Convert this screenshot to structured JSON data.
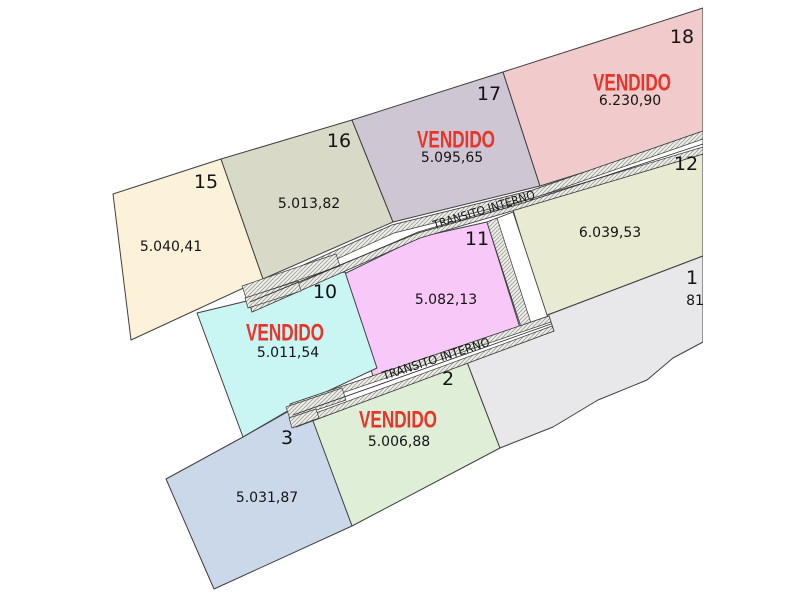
{
  "canvas": {
    "width": 800,
    "height": 600,
    "background": "#ffffff"
  },
  "plan": {
    "sold_label": "VENDIDO",
    "road_label": "TRANSITO INTERNO",
    "colors": {
      "sold_text": "#e8352b",
      "label_text": "#141414",
      "lot_outline": "#3f3f3f",
      "road_fill": "#ffffff",
      "road_outline": "#3f3f3f",
      "hatch_line": "#a0a099",
      "hatch_bg": "#f0f0ec",
      "centerline": "#2f2f2f"
    },
    "lots": [
      {
        "id": "15",
        "number": "15",
        "area": "5.040,41",
        "sold": false,
        "color": "#fcf2d9",
        "points": "113,194 221,159 263,279 131,340",
        "number_pos": [
          206,
          182
        ],
        "area_pos": [
          171,
          247
        ]
      },
      {
        "id": "16",
        "number": "16",
        "area": "5.013,82",
        "sold": false,
        "color": "#d9d9c7",
        "points": "221,159 352,120 393,222 263,279",
        "number_pos": [
          339,
          141
        ],
        "area_pos": [
          309,
          204
        ]
      },
      {
        "id": "17",
        "number": "17",
        "area": "5.095,65",
        "sold": true,
        "color": "#cfc6d3",
        "points": "352,120 503,72 540,186 393,222",
        "number_pos": [
          489,
          94
        ],
        "area_pos": [
          452,
          158
        ],
        "sold_pos": [
          456,
          140
        ]
      },
      {
        "id": "18",
        "number": "18",
        "area": "6.230,90",
        "sold": true,
        "color": "#f1cbcb",
        "points": "503,72 703,8 703,135 540,186",
        "number_pos": [
          682,
          37
        ],
        "area_pos": [
          630,
          101
        ],
        "sold_pos": [
          632,
          83
        ]
      },
      {
        "id": "12",
        "number": "12",
        "area": "6.039,53",
        "sold": false,
        "color": "#e9ead2",
        "points": "513,210 703,152 703,256 545,316",
        "number_pos": [
          686,
          164
        ],
        "area_pos": [
          610,
          233
        ]
      },
      {
        "id": "11",
        "number": "11",
        "area": "5.082,13",
        "sold": false,
        "color": "#f8c9f8",
        "points": "344,274 420,237 487,222 520,328 374,380",
        "number_pos": [
          477,
          239
        ],
        "area_pos": [
          446,
          300
        ]
      },
      {
        "id": "10",
        "number": "10",
        "area": "5.011,54",
        "sold": true,
        "color": "#c9f5f3",
        "points": "197,313 251,300 255,286 345,272 377,368 296,406 243,437",
        "number_pos": [
          325,
          292
        ],
        "area_pos": [
          288,
          353
        ],
        "sold_pos": [
          285,
          333
        ]
      },
      {
        "id": "2",
        "number": "2",
        "area": "5.006,88",
        "sold": true,
        "color": "#dfeed6",
        "points": "312,421 467,362 500,448 352,526",
        "number_pos": [
          448,
          379
        ],
        "area_pos": [
          399,
          442
        ],
        "sold_pos": [
          398,
          420
        ]
      },
      {
        "id": "3",
        "number": "3",
        "area": "5.031,87",
        "sold": false,
        "color": "#cbd8e9",
        "points": "166,479 243,437 296,407 313,421 352,526 214,589",
        "number_pos": [
          287,
          438
        ],
        "area_pos": [
          267,
          498
        ]
      },
      {
        "id": "1",
        "number": "1",
        "area": "81",
        "sold": false,
        "color": "#e8e8eb",
        "points": "545,316 703,256 703,342 673,358 647,380 598,400 553,427 500,448 467,362 521,330",
        "number_pos": [
          692,
          278
        ],
        "area_pos": [
          695,
          301
        ]
      }
    ],
    "roads": [
      {
        "id": "upper",
        "polygon": "246,291 392,225 533,190 703,131 703,154 515,210 420,238 252,312",
        "hatch_bands": [
          "246,291 392,225 533,190 703,131 703,139 534,198 394,233 249,299",
          "250,304 418,232 513,204 703,147 703,154 515,210 420,238 252,312"
        ],
        "jogs": [
          "242,286 336,254 340,266 246,298",
          "245,298 298,281 301,291 248,308"
        ],
        "centerline": "250,302 418,233 520,204 703,144",
        "label": {
          "pos": [
            484,
            210
          ],
          "angle": -17,
          "length": 106
        }
      },
      {
        "id": "vertical",
        "polygon": "487,222 513,212 548,318 522,330",
        "hatch_bands": [
          "487,222 497,218 531,323 522,330"
        ],
        "jogs": [],
        "centerline": null,
        "label": null
      },
      {
        "id": "lower",
        "polygon": "290,404 549,316 554,331 296,427",
        "hatch_bands": [
          "290,404 549,316 551,322 292,410",
          "294,421 552,326 554,331 296,427"
        ],
        "jogs": [
          "286,407 342,388 346,400 290,419",
          "289,418 316,409 319,418 292,428"
        ],
        "centerline": "293,415 551,324",
        "label": {
          "pos": [
            436,
            359
          ],
          "angle": -18,
          "length": 112
        }
      }
    ],
    "letterbox": {
      "x": 703,
      "width": 97
    }
  }
}
